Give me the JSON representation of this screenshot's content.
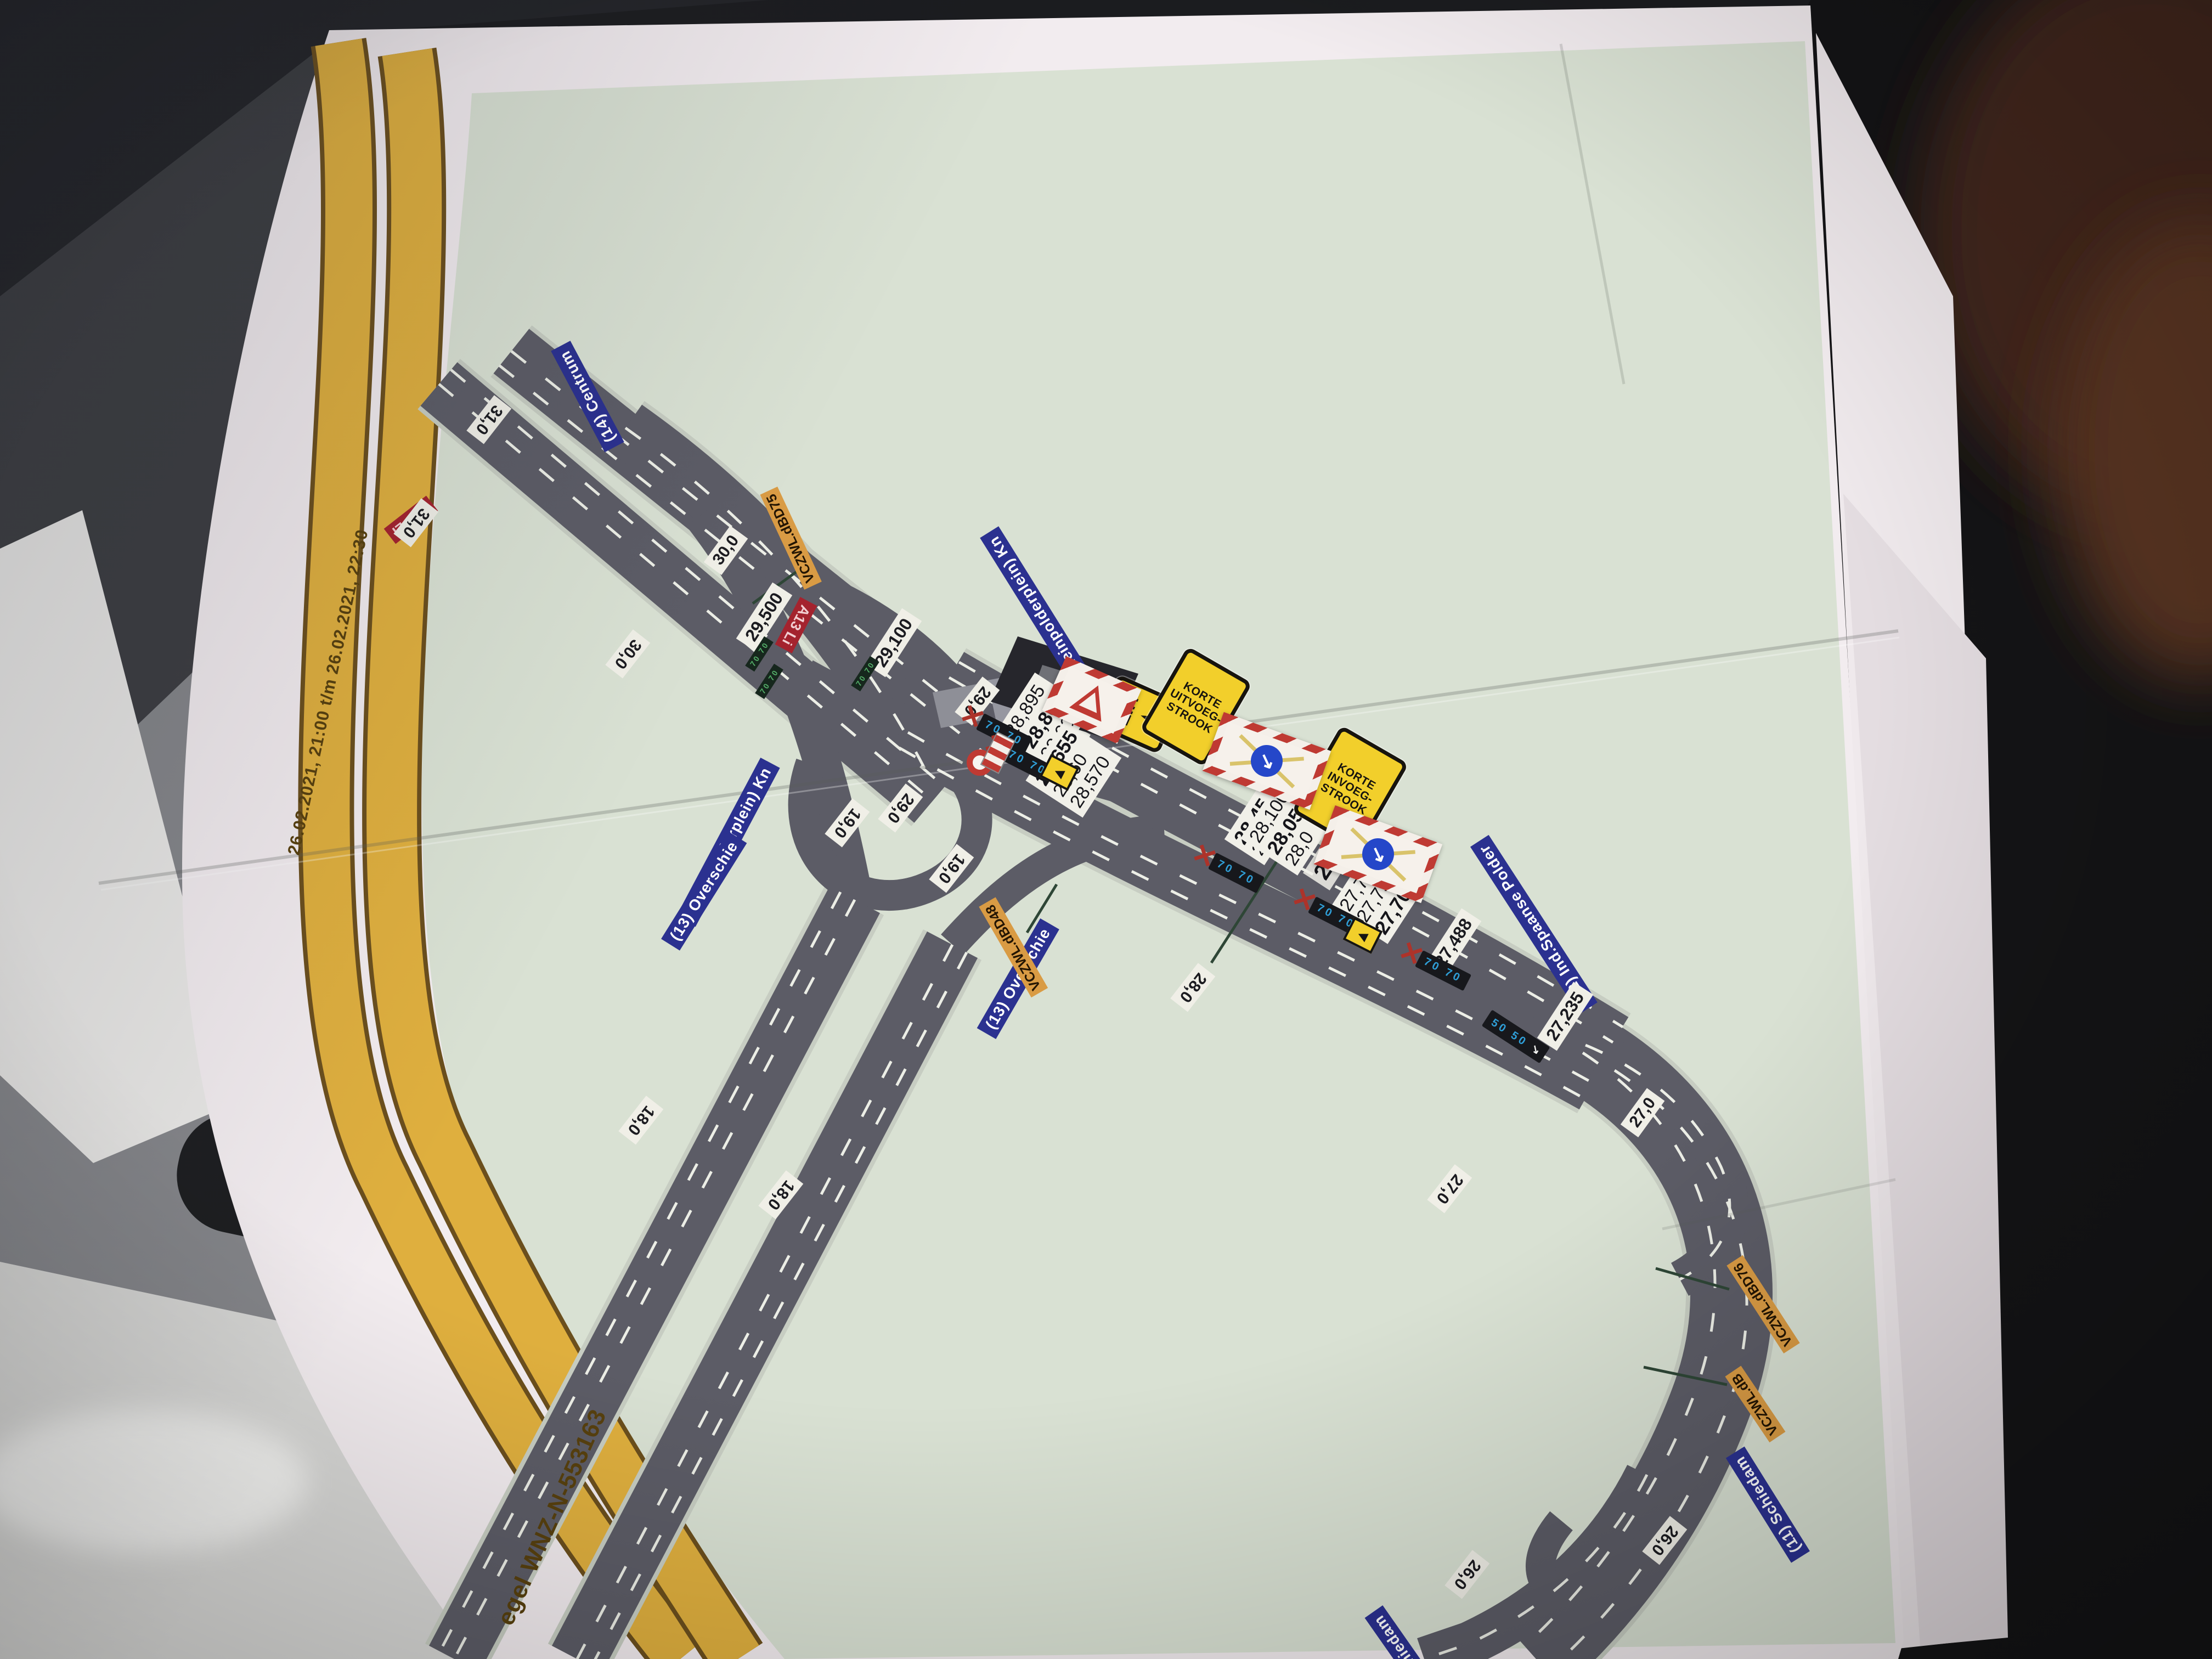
{
  "banner": {
    "date_range": "26.02.2021, 21:00 t/m 26.02.2021, 22:30",
    "measure_id": "egel WNZ-N-553163"
  },
  "blue_labels": {
    "centrum": "(14) Centrum",
    "kleinpolderplein_a": "(Kleinpolderplein) Kn",
    "kleinpolderplein_b": "(Kleinpolderplein) Kn",
    "overschie_a": "(13) Overschie",
    "overschie_b": "(13) Overschie",
    "spaanse_polder": "(12) Ind.Spaanse Polder",
    "schiedam_a": "(11) Schiedam",
    "schiedam_b": "Schiedam"
  },
  "red_labels": {
    "a20": "A20 Li",
    "a13": "A13 Li"
  },
  "orange_labels": {
    "d75": "VCZWL.dBD75",
    "d48": "VCZWL.dBD48",
    "d76": "VCZWL.dBD76",
    "db": "VCZWL.dB"
  },
  "signs": {
    "uit": "UIT",
    "korte_uitvoeg": [
      "KORTE",
      "UITVOEG-",
      "STROOK"
    ],
    "korte_invoeg": [
      "KORTE",
      "INVOEG-",
      "STROOK"
    ]
  },
  "gantry": {
    "speed70": "70 70",
    "speed50": "50 50"
  },
  "km_markers": {
    "k31a": "31,0",
    "k31b": "31,0",
    "k30a": "30,0",
    "k30b": "30,0",
    "k29a": "29,0",
    "k29b": "29,0",
    "k19a": "19,0",
    "k19b": "19,0",
    "k18a": "18,0",
    "k18b": "18,0",
    "k28": "28,0",
    "k27a": "27,0",
    "k27b": "27,0",
    "k26a": "26,0",
    "k26b": "26,0",
    "h29100": "29,100",
    "h29500": "29,500",
    "h27488": "27,488",
    "h27235": "27,235"
  },
  "hm_stacks": {
    "s1": [
      "28,895",
      "28,860",
      "28,600"
    ],
    "s2": [
      "28,655",
      "28,60",
      "28,570"
    ],
    "s3": [
      "28,45",
      "28,410"
    ],
    "s4": [
      "28,100",
      "28,05",
      "28,0"
    ],
    "big": "27,90b",
    "s5": [
      "27,790",
      "27,790b",
      "27,70"
    ]
  },
  "icons": {
    "red_x": "✕",
    "arrow_up_right": "➤",
    "arrow_down_right": "↘",
    "trailer_arrow": "◀"
  },
  "colors": {
    "map_green": "#d9e1d3",
    "road_gray": "#5c5c66",
    "band_yellow": "#dfaf3e",
    "label_blue": "#2b3190",
    "label_orange": "#d99b44",
    "label_red": "#a4232e",
    "closure_red": "#bf3a33",
    "sign_yellow": "#f2cf2b"
  }
}
